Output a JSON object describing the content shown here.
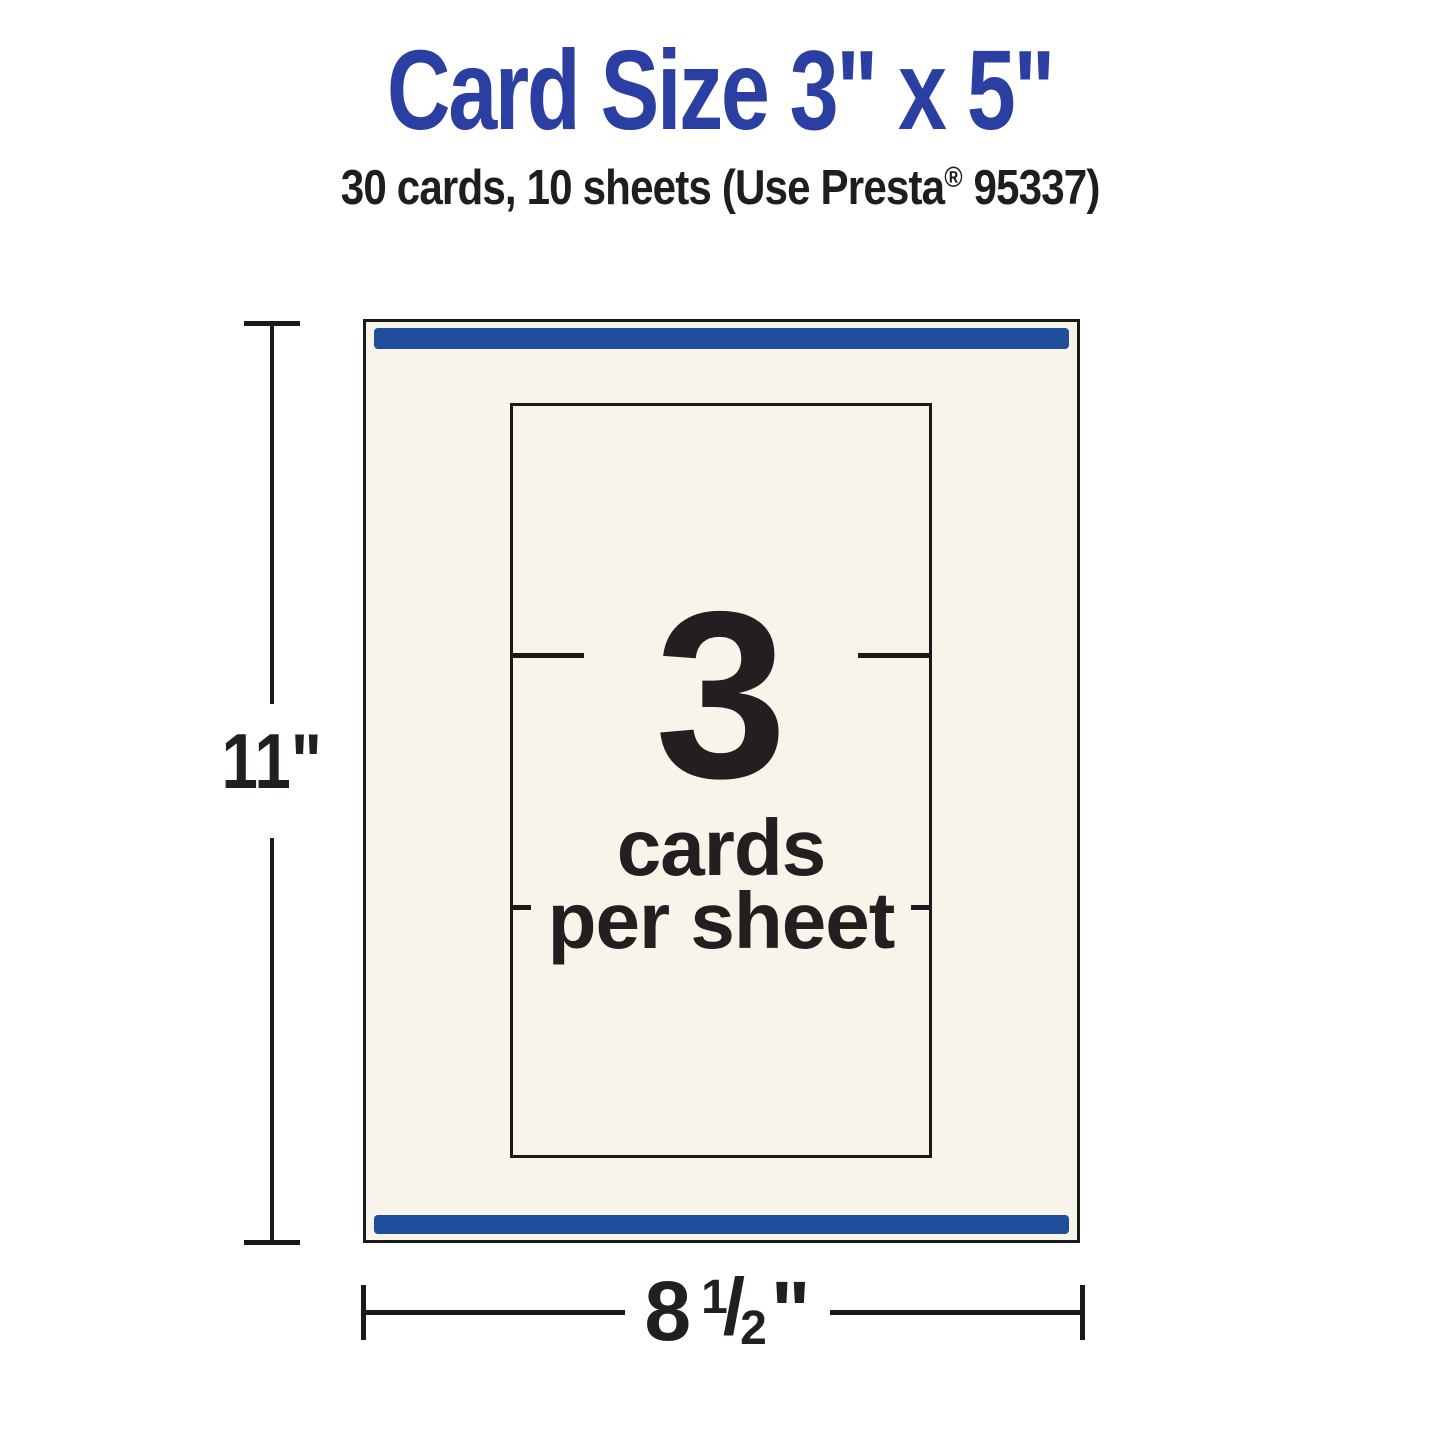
{
  "title": {
    "text": "Card Size 3\" x 5\"",
    "color": "#2B3EA1"
  },
  "subtitle": {
    "prefix": "30 cards, 10 sheets (Use Presta",
    "registered_mark": "®",
    "suffix": " 95337)"
  },
  "sheet": {
    "fill_color": "#F8F4EA",
    "outline_color": "#1A1A1A",
    "accent_bar_color": "#1F4E9C"
  },
  "card_area": {
    "count": "3",
    "label_line1": "cards",
    "label_line2": "per sheet"
  },
  "dimensions": {
    "height": {
      "label": "11\""
    },
    "width": {
      "whole": "8",
      "numerator": "1",
      "slash": "/",
      "denominator": "2",
      "unit": "\""
    }
  }
}
